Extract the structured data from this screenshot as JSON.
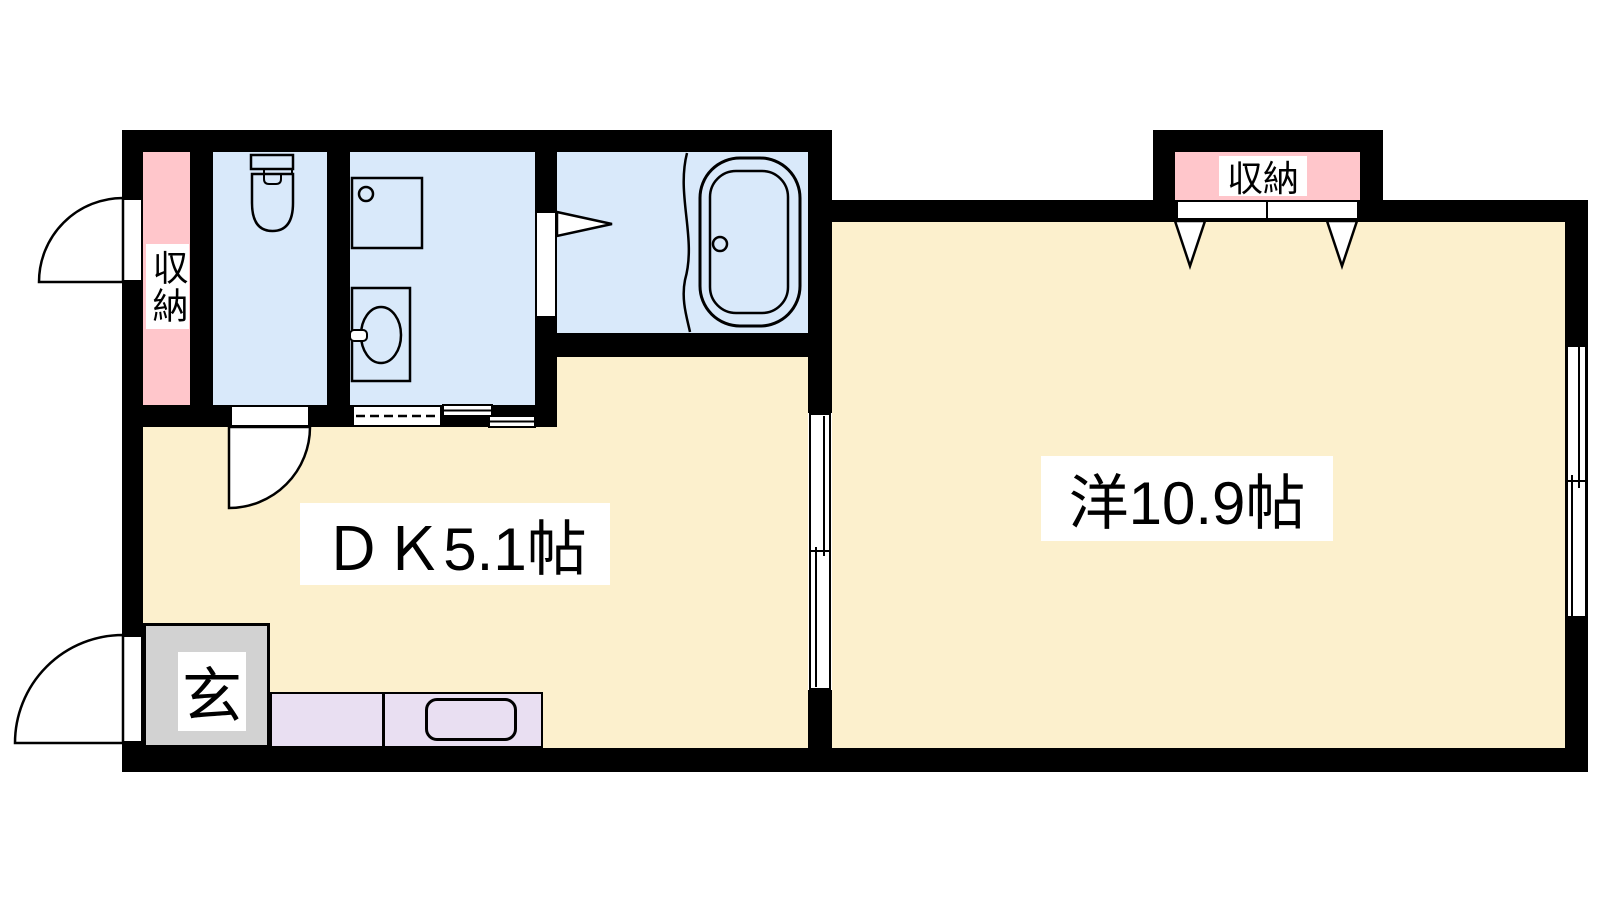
{
  "plan": {
    "type": "japanese-apartment-floor-plan",
    "rooms": {
      "dk": {
        "label": "ＤＫ5.1帖"
      },
      "western_room": {
        "label": "洋10.9帖"
      },
      "entrance": {
        "label": "玄"
      },
      "storage_left": {
        "label": "収納"
      },
      "storage_right": {
        "label": "収納"
      }
    },
    "fixtures": [
      "toilet",
      "washbasin",
      "washing-machine",
      "bathtub",
      "kitchen-counter",
      "kitchen-sink"
    ],
    "openings": [
      "exterior-storage-door",
      "entrance-door",
      "toilet-swing-door",
      "washroom-sliding-door",
      "bathroom-folding-door",
      "dk-western-sliding-door",
      "right-wall-window",
      "closet-folding-doors"
    ],
    "colors": {
      "floor": "#FCF0CD",
      "wet_area": "#D9E9FA",
      "storage": "#FFC6CB",
      "entrance": "#D2D2D2",
      "kitchen": "#E9DFF2",
      "wall": "#000000",
      "label_bg": "#FFFFFF",
      "line": "#000000"
    }
  }
}
